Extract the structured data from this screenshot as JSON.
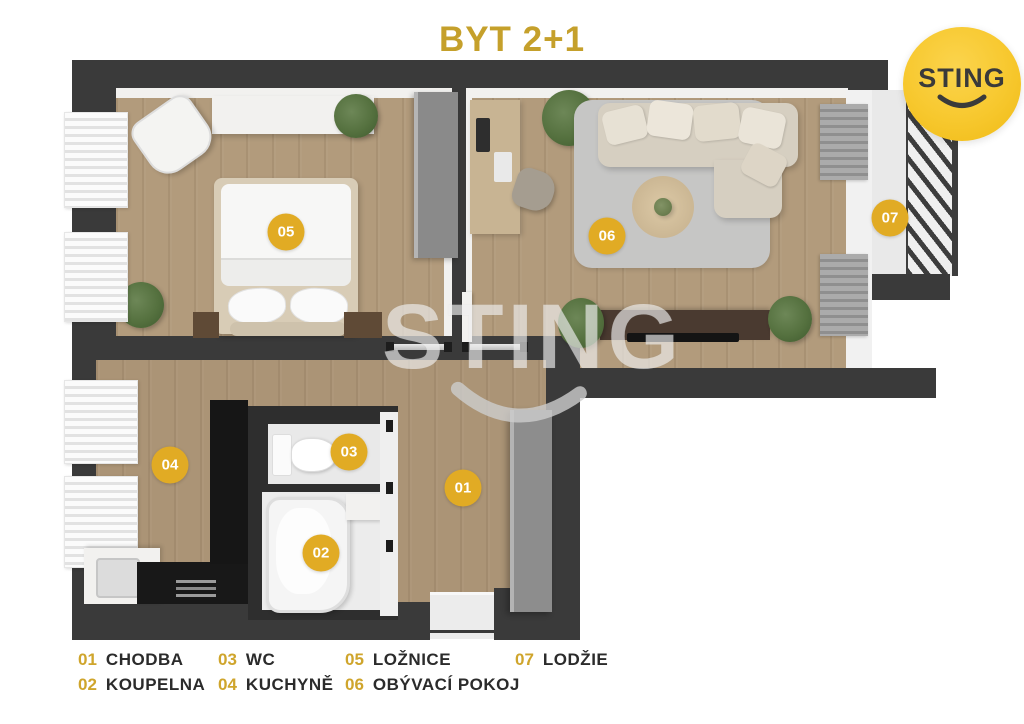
{
  "title": "BYT 2+1",
  "logo": {
    "text": "STING"
  },
  "watermark": {
    "text": "STING"
  },
  "rooms": [
    {
      "number": "01",
      "label": "CHODBA"
    },
    {
      "number": "02",
      "label": "KOUPELNA"
    },
    {
      "number": "03",
      "label": "WC"
    },
    {
      "number": "04",
      "label": "KUCHYNĚ"
    },
    {
      "number": "05",
      "label": "LOŽNICE"
    },
    {
      "number": "06",
      "label": "OBÝVACÍ POKOJ"
    },
    {
      "number": "07",
      "label": "LODŽIE"
    }
  ],
  "colors": {
    "title_gold": "#c5a02b",
    "legend_number_gold": "#cfa52c",
    "marker_gold": "#e1ab24",
    "logo_yellow": "#f7c82e",
    "wall_dark": "#3a3a3a",
    "floor_wood": "#b29b7c"
  }
}
